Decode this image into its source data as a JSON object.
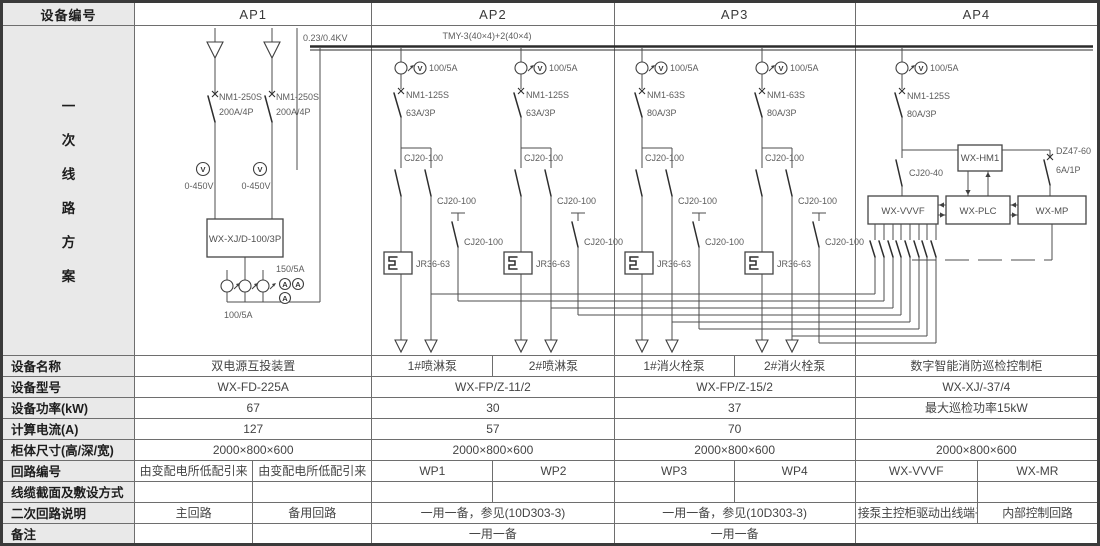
{
  "header": {
    "device_no": "设备编号",
    "ap1": "AP1",
    "ap2": "AP2",
    "ap3": "AP3",
    "ap4": "AP4"
  },
  "section": {
    "chars": [
      "一",
      "次",
      "线",
      "路",
      "方",
      "案"
    ]
  },
  "diagram": {
    "voltage": "0.23/0.4KV",
    "busbar_spec": "TMY-3(40×4)+2(40×4)",
    "meters": {
      "v": "V",
      "a": "A"
    },
    "ap1": {
      "breaker": "NM1-250S",
      "rating": "200A/4P",
      "volt_range": "0-450V",
      "ats": "WX-XJ/D-100/3P",
      "ct_ratio": "100/5A",
      "amp_ratio": "150/5A"
    },
    "feeder": {
      "ct_ratio": "100/5A",
      "contactor": "CJ20-100",
      "relay": "JR36-63"
    },
    "ap2": {
      "breaker": "NM1-125S",
      "rating": "63A/3P"
    },
    "ap3": {
      "breaker": "NM1-63S",
      "rating": "80A/3P"
    },
    "ap4": {
      "breaker": "NM1-125S",
      "rating": "80A/3P",
      "contactor": "CJ20-40",
      "aux_breaker": "DZ47-60",
      "aux_rating": "6A/1P",
      "vvvf": "WX-VVVF",
      "plc": "WX-PLC",
      "mp": "WX-MP",
      "hmi": "WX-HM1"
    }
  },
  "table": {
    "labels": {
      "name": "设备名称",
      "model": "设备型号",
      "power": "设备功率(kW)",
      "current": "计算电流(A)",
      "size": "柜体尺寸(高/深/宽)",
      "circuit": "回路编号",
      "cable": "线缆截面及敷设方式",
      "secondary": "二次回路说明",
      "remark": "备注"
    },
    "name": {
      "ap1": "双电源互投装置",
      "ap2a": "1#喷淋泵",
      "ap2b": "2#喷淋泵",
      "ap3a": "1#消火栓泵",
      "ap3b": "2#消火栓泵",
      "ap4": "数字智能消防巡检控制柜"
    },
    "model": {
      "ap1": "WX-FD-225A",
      "ap2": "WX-FP/Z-11/2",
      "ap3": "WX-FP/Z-15/2",
      "ap4": "WX-XJ/-37/4"
    },
    "power": {
      "ap1": "67",
      "ap2": "30",
      "ap3": "37",
      "ap4": "最大巡检功率15kW"
    },
    "current": {
      "ap1": "127",
      "ap2": "57",
      "ap3": "70"
    },
    "size": {
      "ap1": "2000×800×600",
      "ap2": "2000×800×600",
      "ap3": "2000×800×600",
      "ap4": "2000×800×600"
    },
    "circuit": {
      "ap1a": "由变配电所低配引来",
      "ap1b": "由变配电所低配引来",
      "ap2a": "WP1",
      "ap2b": "WP2",
      "ap3a": "WP3",
      "ap3b": "WP4",
      "ap4a": "WX-VVVF",
      "ap4b": "WX-MR"
    },
    "secondary": {
      "ap1a": "主回路",
      "ap1b": "备用回路",
      "ap2": "一用一备，参见(10D303-3)",
      "ap3": "一用一备，参见(10D303-3)",
      "ap4a": "接泵主控柜驱动出线端子",
      "ap4b": "内部控制回路"
    },
    "remark": {
      "ap2": "一用一备",
      "ap3": "一用一备"
    }
  }
}
